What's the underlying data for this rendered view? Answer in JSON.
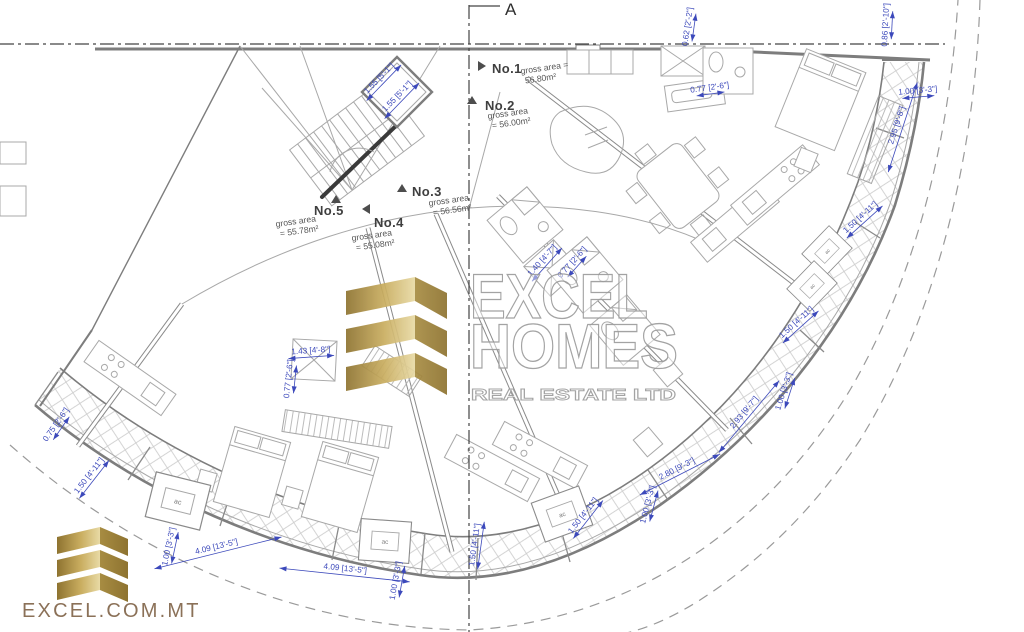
{
  "section_marker": {
    "label": "A"
  },
  "units": [
    {
      "label": "No.1",
      "area_line1": "gross area =",
      "area_line2": "56.80m²",
      "marker": "right",
      "mx": 478,
      "my": 66,
      "lx": 492,
      "ly": 73,
      "ax": 521,
      "ay": 74,
      "ar": -8
    },
    {
      "label": "No.2",
      "area_line1": "gross area",
      "area_line2": "= 56.00m²",
      "marker": "up",
      "mx": 472,
      "my": 100,
      "lx": 485,
      "ly": 110,
      "ax": 488,
      "ay": 119,
      "ar": -8
    },
    {
      "label": "No.3",
      "area_line1": "gross area",
      "area_line2": "= 56.56m²",
      "marker": "up",
      "mx": 402,
      "my": 188,
      "lx": 412,
      "ly": 196,
      "ax": 429,
      "ay": 206,
      "ar": -8
    },
    {
      "label": "No.4",
      "area_line1": "gross area",
      "area_line2": "= 55.08m²",
      "marker": "left",
      "mx": 362,
      "my": 209,
      "lx": 374,
      "ly": 227,
      "ax": 352,
      "ay": 241,
      "ar": -8
    },
    {
      "label": "No.5",
      "area_line1": "gross area",
      "area_line2": "= 55.78m²",
      "marker": "up",
      "mx": 336,
      "my": 199,
      "lx": 314,
      "ly": 215,
      "ax": 276,
      "ay": 227,
      "ar": -8
    }
  ],
  "dimensions": [
    {
      "text": "0.62 [2'-2\"]",
      "x": 690,
      "y": 27,
      "r": -82
    },
    {
      "text": "0.86 [2'-10\"]",
      "x": 888,
      "y": 25,
      "r": -87
    },
    {
      "text": "0.77 [2'-6\"]",
      "x": 710,
      "y": 90,
      "r": -8
    },
    {
      "text": "1.00 [3'-3\"]",
      "x": 918,
      "y": 93,
      "r": -5
    },
    {
      "text": "2.95 [9'-8\"]",
      "x": 899,
      "y": 126,
      "r": -72
    },
    {
      "text": "1.50 [4'-11\"]",
      "x": 862,
      "y": 219,
      "r": -42
    },
    {
      "text": "1.50 [4'-11\"]",
      "x": 798,
      "y": 324,
      "r": -42
    },
    {
      "text": "1.00 [3'-3\"]",
      "x": 786,
      "y": 392,
      "r": -72
    },
    {
      "text": "2.93 [9'-7\"]",
      "x": 746,
      "y": 414,
      "r": -50
    },
    {
      "text": "2.80 [9'-3\"]",
      "x": 678,
      "y": 471,
      "r": -27
    },
    {
      "text": "1.00 [3'-3\"]",
      "x": 650,
      "y": 505,
      "r": -75
    },
    {
      "text": "1.50 [4'-11\"]",
      "x": 585,
      "y": 517,
      "r": -52
    },
    {
      "text": "1.50 [4'-11\"]",
      "x": 477,
      "y": 545,
      "r": -82
    },
    {
      "text": "1.00 [3'-3\"]",
      "x": 398,
      "y": 581,
      "r": -80
    },
    {
      "text": "4.09 [13'-5\"]",
      "x": 345,
      "y": 571,
      "r": 6
    },
    {
      "text": "4.09 [13'-5\"]",
      "x": 217,
      "y": 549,
      "r": -14
    },
    {
      "text": "1.00 [3'-3\"]",
      "x": 171,
      "y": 547,
      "r": -78
    },
    {
      "text": "1.50 [4'-11\"]",
      "x": 91,
      "y": 477,
      "r": -52
    },
    {
      "text": "0.75 [2'-6\"]",
      "x": 58,
      "y": 426,
      "r": -55
    },
    {
      "text": "1.55 [5'-1\"]",
      "x": 381,
      "y": 80,
      "r": -46
    },
    {
      "text": "1.55 [5'-1\"]",
      "x": 399,
      "y": 98,
      "r": -46
    },
    {
      "text": "1.43 [4'-8\"]",
      "x": 311,
      "y": 353,
      "r": -4
    },
    {
      "text": "0.77 [2'-6\"]",
      "x": 291,
      "y": 379,
      "r": -84
    },
    {
      "text": "1.40 [4'-7\"]",
      "x": 544,
      "y": 262,
      "r": -48
    },
    {
      "text": "0.77 [2'-6\"]",
      "x": 574,
      "y": 264,
      "r": -48
    }
  ],
  "ac_label": "ac",
  "ac_units": [
    {
      "x": 178,
      "y": 501,
      "r": 14,
      "s": 1
    },
    {
      "x": 385,
      "y": 541,
      "r": 4,
      "s": 0.9
    },
    {
      "x": 562,
      "y": 514,
      "r": -20,
      "s": 0.9
    },
    {
      "x": 827,
      "y": 251,
      "r": -46,
      "s": 0.7
    },
    {
      "x": 812,
      "y": 286,
      "r": -46,
      "s": 0.7
    }
  ],
  "watermark": {
    "line1": "EXCEL",
    "line2": "HOMES",
    "line3": "REAL ESTATE LTD"
  },
  "footer_logo": {
    "text": "EXCEL.COM.MT"
  },
  "colors": {
    "dimension_blue": "#3c49bb",
    "wall_gray": "#7d7d7d",
    "gold_dark": "#8e7330",
    "gold_light": "#e3d193",
    "logo_text_brown": "#8b7158"
  }
}
